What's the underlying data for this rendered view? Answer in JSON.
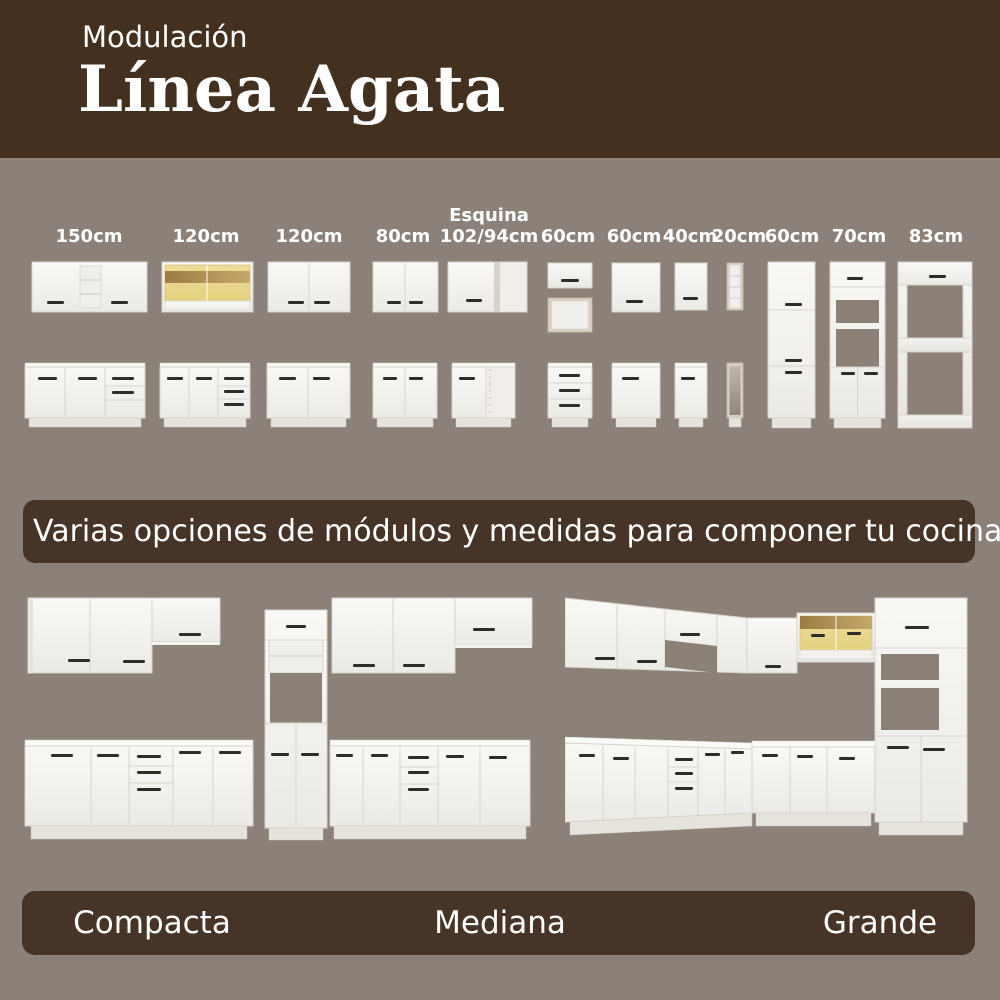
{
  "header": {
    "kicker": "Modulación",
    "title": "Línea Agata"
  },
  "modules": {
    "items": [
      {
        "label": "150cm"
      },
      {
        "label": "120cm"
      },
      {
        "label": "120cm"
      },
      {
        "label": "80cm"
      },
      {
        "label": "Esquina",
        "sublabel": "102/94cm"
      },
      {
        "label": "60cm"
      },
      {
        "label": "60cm"
      },
      {
        "label": "40cm"
      },
      {
        "label": "20cm"
      },
      {
        "label": "60cm"
      },
      {
        "label": "70cm"
      },
      {
        "label": "83cm"
      }
    ]
  },
  "banner": {
    "text": "Varias opciones de módulos y medidas para componer tu cocina"
  },
  "kitchens": {
    "items": [
      {
        "name": "Compacta"
      },
      {
        "name": "Mediana"
      },
      {
        "name": "Grande"
      }
    ]
  },
  "colors": {
    "header_bg": "#43301f",
    "panel_bg": "#463428",
    "canvas_bg": "#8b8179",
    "cabinet_white": "#f6f5f1",
    "wood_accent": "#a5854e",
    "glass_tint": "#e9d88f",
    "handle_dark": "#2f2d2a"
  }
}
